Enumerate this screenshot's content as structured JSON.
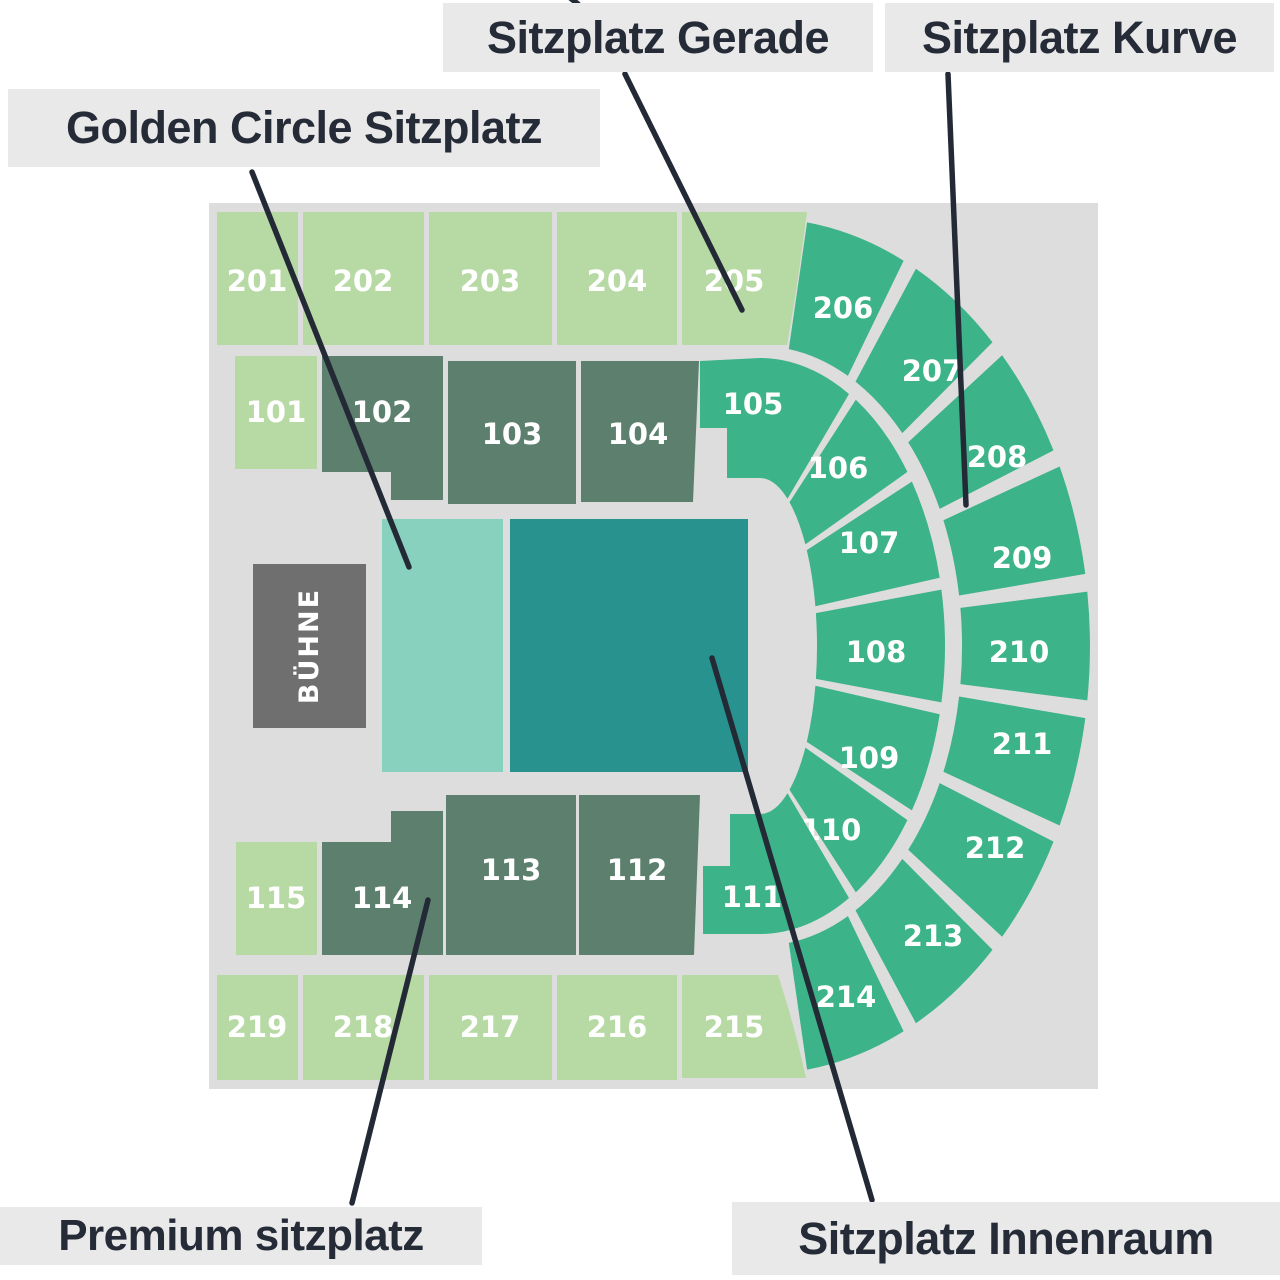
{
  "map": {
    "background_color": "#dddddd",
    "section_text_color": "#ffffff",
    "colors": {
      "light_green": "#b7daa5",
      "mid_green": "#3cb389",
      "dark_sage": "#5c806d",
      "light_teal": "#88d1bf",
      "dark_teal": "#28928f"
    },
    "stage": {
      "label": "BÜHNE",
      "color": "#6f6f6f",
      "text_color": "#ffffff"
    },
    "sections": [
      {
        "id": "201",
        "label": "201",
        "category": "light_green"
      },
      {
        "id": "202",
        "label": "202",
        "category": "light_green"
      },
      {
        "id": "203",
        "label": "203",
        "category": "light_green"
      },
      {
        "id": "204",
        "label": "204",
        "category": "light_green"
      },
      {
        "id": "205",
        "label": "205",
        "category": "light_green"
      },
      {
        "id": "206",
        "label": "206",
        "category": "mid_green"
      },
      {
        "id": "207",
        "label": "207",
        "category": "mid_green"
      },
      {
        "id": "208",
        "label": "208",
        "category": "mid_green"
      },
      {
        "id": "209",
        "label": "209",
        "category": "mid_green"
      },
      {
        "id": "210",
        "label": "210",
        "category": "mid_green"
      },
      {
        "id": "211",
        "label": "211",
        "category": "mid_green"
      },
      {
        "id": "212",
        "label": "212",
        "category": "mid_green"
      },
      {
        "id": "213",
        "label": "213",
        "category": "mid_green"
      },
      {
        "id": "214",
        "label": "214",
        "category": "mid_green"
      },
      {
        "id": "215",
        "label": "215",
        "category": "light_green"
      },
      {
        "id": "216",
        "label": "216",
        "category": "light_green"
      },
      {
        "id": "217",
        "label": "217",
        "category": "light_green"
      },
      {
        "id": "218",
        "label": "218",
        "category": "light_green"
      },
      {
        "id": "219",
        "label": "219",
        "category": "light_green"
      },
      {
        "id": "101",
        "label": "101",
        "category": "light_green"
      },
      {
        "id": "102",
        "label": "102",
        "category": "dark_sage"
      },
      {
        "id": "103",
        "label": "103",
        "category": "dark_sage"
      },
      {
        "id": "104",
        "label": "104",
        "category": "dark_sage"
      },
      {
        "id": "105",
        "label": "105",
        "category": "mid_green"
      },
      {
        "id": "106",
        "label": "106",
        "category": "mid_green"
      },
      {
        "id": "107",
        "label": "107",
        "category": "mid_green"
      },
      {
        "id": "108",
        "label": "108",
        "category": "mid_green"
      },
      {
        "id": "109",
        "label": "109",
        "category": "mid_green"
      },
      {
        "id": "110",
        "label": "110",
        "category": "mid_green"
      },
      {
        "id": "111",
        "label": "111",
        "category": "mid_green"
      },
      {
        "id": "112",
        "label": "112",
        "category": "dark_sage"
      },
      {
        "id": "113",
        "label": "113",
        "category": "dark_sage"
      },
      {
        "id": "114",
        "label": "114",
        "category": "dark_sage"
      },
      {
        "id": "115",
        "label": "115",
        "category": "light_green"
      },
      {
        "id": "golden_circle",
        "label": "",
        "category": "light_teal"
      },
      {
        "id": "innenraum",
        "label": "",
        "category": "dark_teal"
      }
    ]
  },
  "legend": {
    "background": "#e9e9e9",
    "text_color": "#262b38",
    "line_color": "#232a36",
    "labels": [
      {
        "id": "golden_circle",
        "text": "Golden Circle Sitzplatz"
      },
      {
        "id": "gerade",
        "text": "Sitzplatz Gerade"
      },
      {
        "id": "kurve",
        "text": "Sitzplatz Kurve"
      },
      {
        "id": "premium",
        "text": "Premium sitzplatz"
      },
      {
        "id": "innenraum",
        "text": "Sitzplatz Innenraum"
      }
    ]
  }
}
